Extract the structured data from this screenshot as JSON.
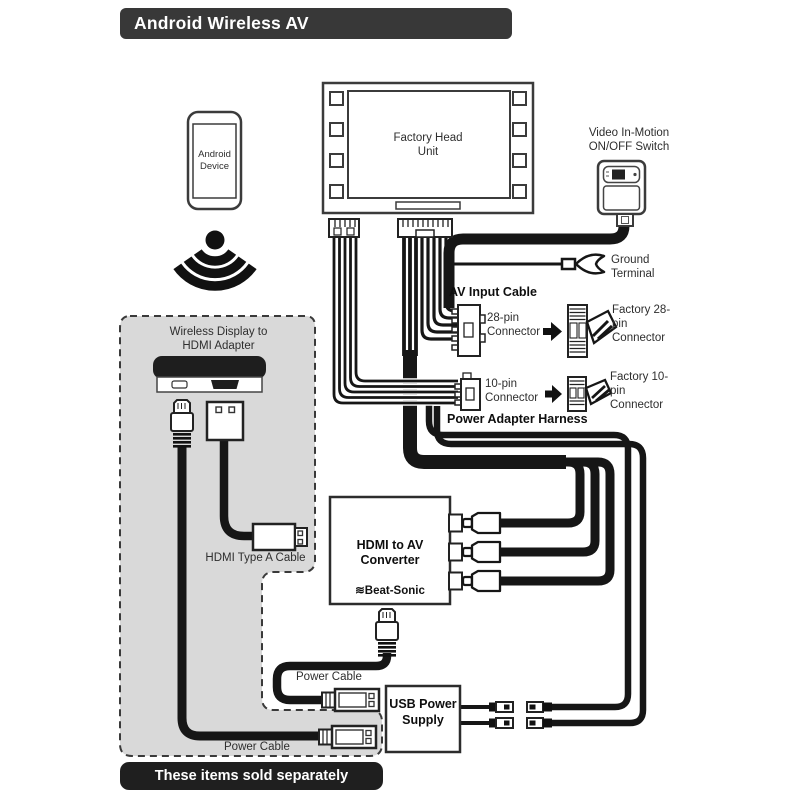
{
  "title": "Android Wireless AV",
  "footer": "These items sold separately",
  "colors": {
    "title_bar": "#383838",
    "footer_bar": "#1f1f1f",
    "gray_region": "#d9d9d9",
    "cable": "#161616",
    "outline": "#3b3b3b"
  },
  "labels": {
    "android_device": "Android Device",
    "head_unit": "Factory Head Unit",
    "video_switch": "Video In-Motion ON/OFF Switch",
    "ground_terminal": "Ground Terminal",
    "av_input_cable": "AV Input Cable",
    "pin28": "28-pin Connector",
    "factory_pin28": "Factory 28-pin Connector",
    "pin10": "10-pin Connector",
    "factory_pin10": "Factory 10-pin Connector",
    "power_adapter_harness": "Power Adapter Harness",
    "wireless_adapter": "Wireless Display to HDMI Adapter",
    "hdmi_cable": "HDMI Type A Cable",
    "converter": "HDMI to AV Converter",
    "brand_mark": "≋",
    "brand": "Beat-Sonic",
    "power_cable_top": "Power Cable",
    "power_cable_bottom": "Power Cable",
    "usb_power_supply": "USB Power Supply"
  }
}
